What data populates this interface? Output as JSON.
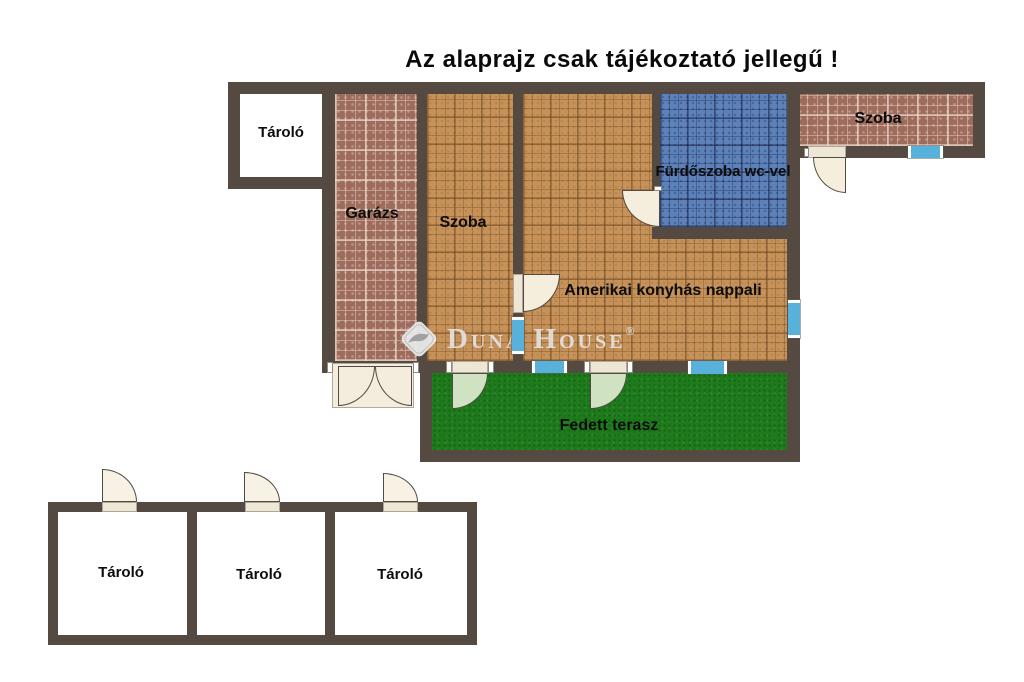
{
  "title": "Az alaprajz csak tájékoztató jellegű !",
  "watermark": {
    "brand": "Duna House",
    "registered_mark": "®",
    "logo_icon": "duna-house-diamond-wave-logo"
  },
  "rooms": {
    "storage_top_left": {
      "label": "Tároló"
    },
    "garage": {
      "label": "Garázs"
    },
    "room_left": {
      "label": "Szoba"
    },
    "bathroom": {
      "label": "Fürdőszoba wc-vel"
    },
    "living_room": {
      "label": "Amerikai konyhás nappali"
    },
    "room_right": {
      "label": "Szoba"
    },
    "terrace": {
      "label": "Fedett terasz"
    },
    "storage_1": {
      "label": "Tároló"
    },
    "storage_2": {
      "label": "Tároló"
    },
    "storage_3": {
      "label": "Tároló"
    }
  },
  "colors": {
    "wall": "#554a41",
    "tile_orange": "#c6925a",
    "tile_brick": "#9e6c5c",
    "tile_blue": "#5d81b9",
    "terrace_green": "#1e7b1c",
    "window_blue": "#57b1da",
    "door_cream": "#f6eedd",
    "door_green": "#cfe3c3",
    "watermark_gray": "#e2e2e2"
  }
}
